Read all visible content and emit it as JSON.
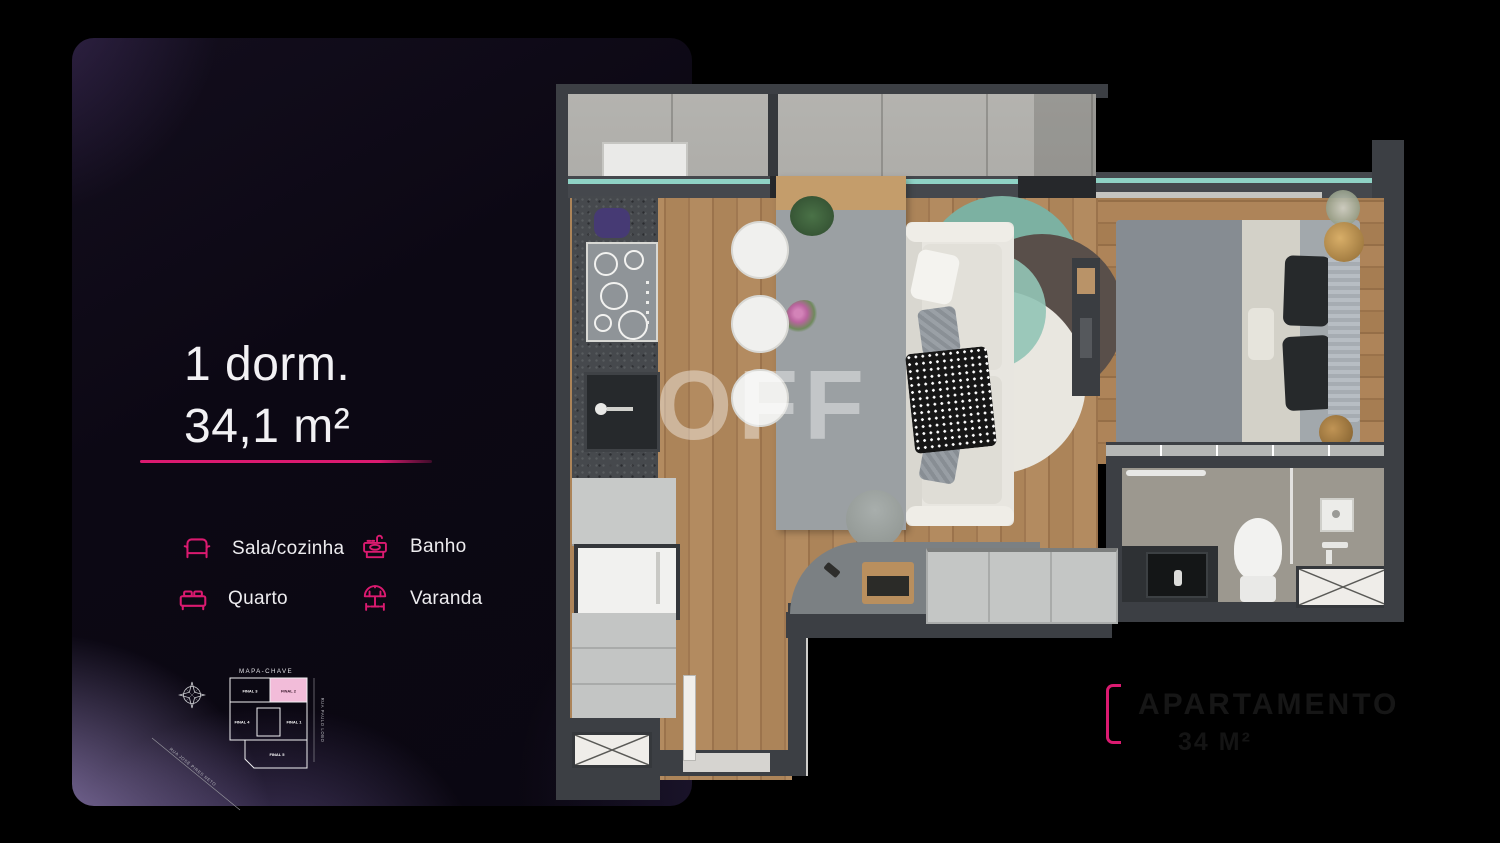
{
  "panel": {
    "title_line1": "1 dorm.",
    "title_line2": "34,1 m²",
    "accent_color": "#DB1A70",
    "legend": [
      {
        "icon": "sofa-icon",
        "label": "Sala/cozinha"
      },
      {
        "icon": "washbasin-icon",
        "label": "Banho"
      },
      {
        "icon": "bed-icon",
        "label": "Quarto"
      },
      {
        "icon": "parasol-icon",
        "label": "Varanda"
      }
    ],
    "map_key": {
      "title": "MAPA-CHAVE",
      "highlighted_unit": "FINAL 2",
      "highlight_color": "#F2BCD9",
      "units": {
        "top_left": "FINAL 3",
        "top_right": "FINAL 2",
        "mid_left": "FINAL 4",
        "mid_right": "FINAL 1",
        "bottom": "FINAL 5"
      },
      "street_left": "RUA JOSÉ PIRES NETO",
      "street_right": "RUA PAULO LOBO"
    }
  },
  "floor_plan": {
    "watermark": "OFF",
    "caption_line1": "APARTAMENTO",
    "caption_line2": "34 M²",
    "rooms": [
      "Sala/cozinha",
      "Quarto",
      "Banho",
      "Varanda"
    ]
  }
}
